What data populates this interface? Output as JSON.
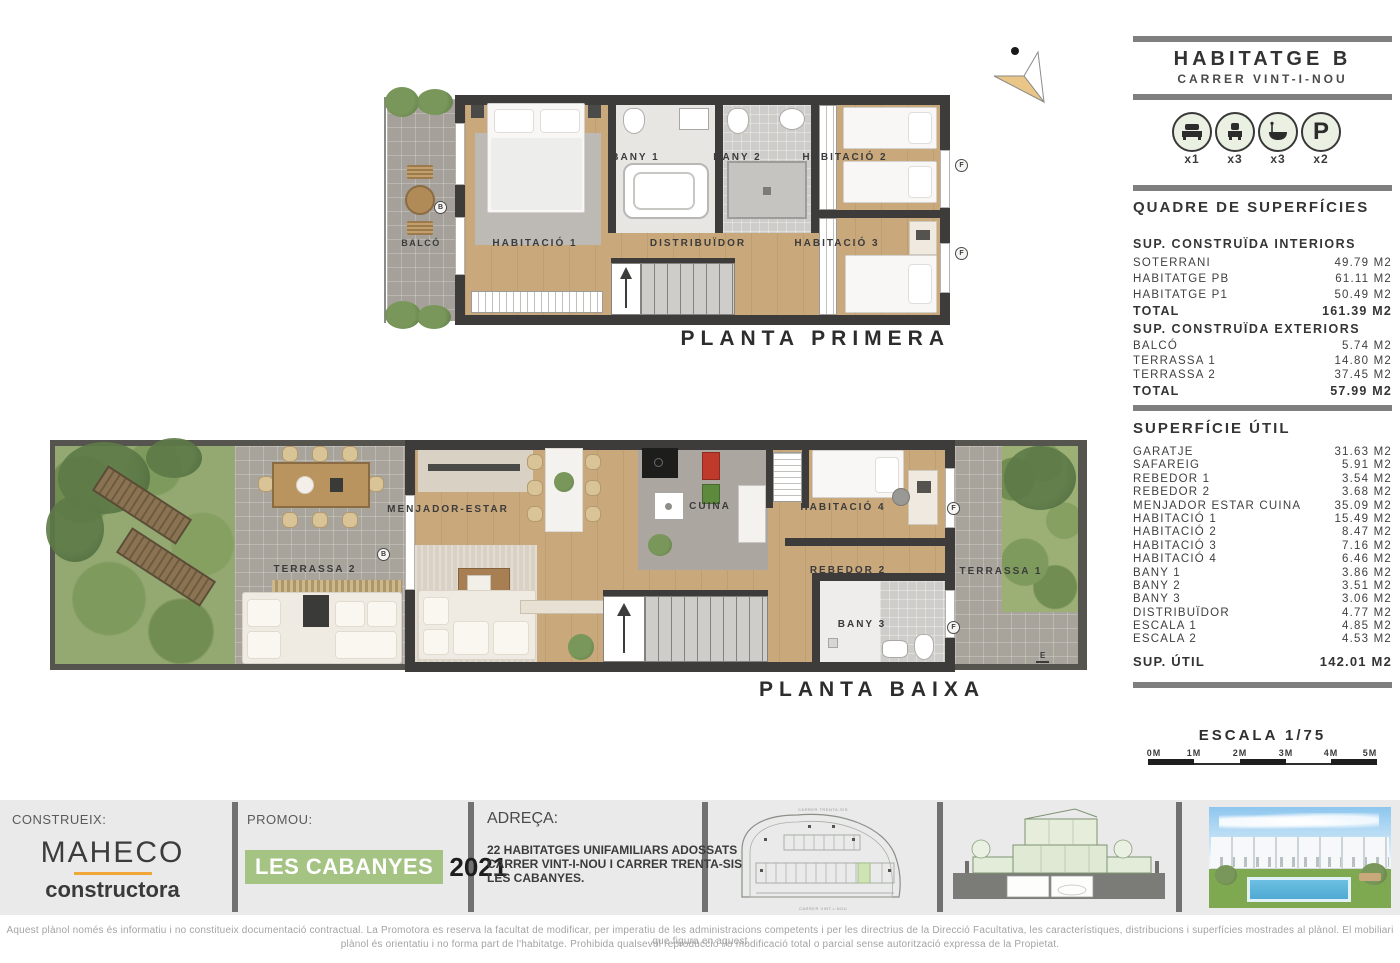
{
  "header": {
    "title": "HABITATGE B",
    "subtitle": "CARRER VINT-I-NOU",
    "icons": [
      {
        "name": "double-bed",
        "count": "x1"
      },
      {
        "name": "single-bed",
        "count": "x3"
      },
      {
        "name": "bathtub",
        "count": "x3"
      },
      {
        "name": "parking",
        "letter": "P",
        "count": "x2"
      }
    ],
    "table_title": "QUADRE DE SUPERFÍCIES"
  },
  "surfaces": {
    "interiors": {
      "heading": "SUP. CONSTRUÏDA INTERIORS",
      "rows": [
        {
          "label": "SOTERRANI",
          "value": "49.79 M2"
        },
        {
          "label": "HABITATGE PB",
          "value": "61.11 M2"
        },
        {
          "label": "HABITATGE P1",
          "value": "50.49 M2"
        }
      ],
      "total": {
        "label": "TOTAL",
        "value": "161.39 M2"
      }
    },
    "exteriors": {
      "heading": "SUP. CONSTRUÏDA EXTERIORS",
      "rows": [
        {
          "label": "BALCÓ",
          "value": "5.74 M2"
        },
        {
          "label": "TERRASSA 1",
          "value": "14.80 M2"
        },
        {
          "label": "TERRASSA 2",
          "value": "37.45 M2"
        }
      ],
      "total": {
        "label": "TOTAL",
        "value": "57.99 M2"
      }
    },
    "util": {
      "heading": "SUPERFÍCIE ÚTIL",
      "rows": [
        {
          "label": "GARATJE",
          "value": "31.63 M2"
        },
        {
          "label": "SAFAREIG",
          "value": "5.91 M2"
        },
        {
          "label": "REBEDOR 1",
          "value": "3.54 M2"
        },
        {
          "label": "REBEDOR 2",
          "value": "3.68 M2"
        },
        {
          "label": "MENJADOR ESTAR CUINA",
          "value": "35.09 M2"
        },
        {
          "label": "HABITACIÓ 1",
          "value": "15.49 M2"
        },
        {
          "label": "HABITACIÓ 2",
          "value": "8.47 M2"
        },
        {
          "label": "HABITACIÓ 3",
          "value": "7.16 M2"
        },
        {
          "label": "HABITACIÓ 4",
          "value": "6.46 M2"
        },
        {
          "label": "BANY 1",
          "value": "3.86 M2"
        },
        {
          "label": "BANY 2",
          "value": "3.51 M2"
        },
        {
          "label": "BANY 3",
          "value": "3.06 M2"
        },
        {
          "label": "DISTRIBUÏDOR",
          "value": "4.77 M2"
        },
        {
          "label": "ESCALA 1",
          "value": "4.85 M2"
        },
        {
          "label": "ESCALA 2",
          "value": "4.53 M2"
        }
      ],
      "total": {
        "label": "SUP. ÚTIL",
        "value": "142.01 M2"
      }
    }
  },
  "scale": {
    "title": "ESCALA 1/75",
    "ticks": [
      "0M",
      "1M",
      "2M",
      "3M",
      "4M",
      "5M"
    ]
  },
  "plans": {
    "primera": {
      "title": "PLANTA PRIMERA",
      "rooms": {
        "balco": "BALCÓ",
        "hab1": "HABITACIÓ 1",
        "bany1": "BANY 1",
        "bany2": "BANY 2",
        "hab2": "HABITACIÓ 2",
        "distribuidor": "DISTRIBUÏDOR",
        "hab3": "HABITACIÓ 3"
      },
      "markers": {
        "b": "B",
        "f": "F"
      }
    },
    "baixa": {
      "title": "PLANTA BAIXA",
      "rooms": {
        "terrassa2": "TERRASSA 2",
        "menjador": "MENJADOR-ESTAR",
        "cuina": "CUINA",
        "hab4": "HABITACIÓ 4",
        "rebedor2": "REBEDOR 2",
        "bany3": "BANY 3",
        "terrassa1": "TERRASSA 1"
      },
      "markers": {
        "b": "B",
        "f": "F",
        "e": "E"
      }
    }
  },
  "footer": {
    "construeix_label": "CONSTRUEIX:",
    "builder_name": "MAHECO",
    "builder_sub": "constructora",
    "promou_label": "PROMOU:",
    "promotion_name": "LES CABANYES",
    "promotion_year": "2021",
    "adreca_label": "ADREÇA:",
    "address_lines": [
      "22 HABITATGES UNIFAMILIARS ADOSSATS",
      "CARRER VINT-I-NOU I CARRER TRENTA-SIS",
      "LES CABANYES."
    ],
    "site_plan": {
      "top_label": "CARRER TRENTA-SIS",
      "bottom_label": "CARRER VINT-I-NOU"
    }
  },
  "disclaimer": {
    "line1": "Aquest plànol només és informatiu i no constitueix documentació contractual. La Promotora es reserva la facultat de modificar, per imperatiu de les administracions competents i per les directrius de la Direcció Facultativa, les característiques, distribucions i superfícies mostrades al plànol. El mobiliari que figura en aquest",
    "line2": "plànol és orientatiu i no forma part de l'habitatge. Prohibida qualsevol reproducció i/o modificació total o parcial sense autorització expressa de la Propietat."
  },
  "colors": {
    "wall": "#3d3c3a",
    "wood_floor": "#c9a87c",
    "terrace_gray": "#a8a49c",
    "grass_green": "#94a871",
    "accent_orange": "#efa73c",
    "accent_green": "#a5c383",
    "separator_gray": "#7f7f7f",
    "footer_bg": "#eaeaea"
  }
}
